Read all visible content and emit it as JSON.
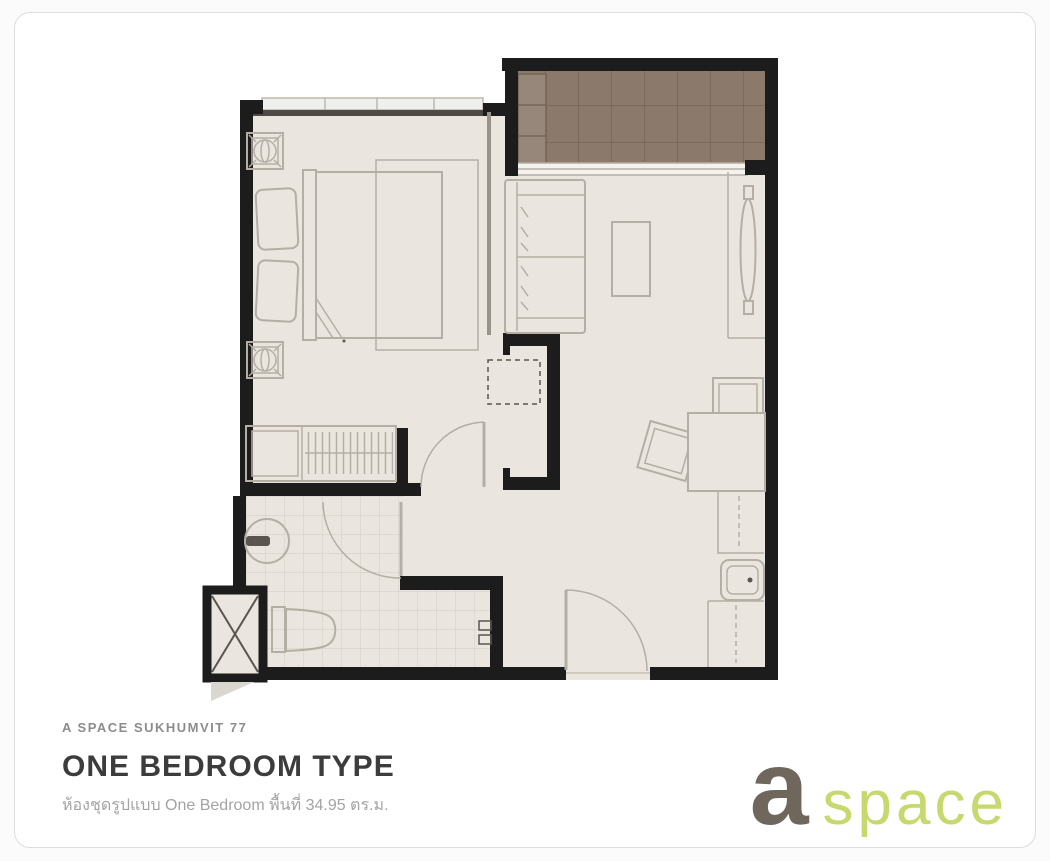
{
  "plan": {
    "kind": "condominium unit floor plan",
    "unit_type": "One Bedroom",
    "area_sqm": "34.95",
    "features": [
      "balcony",
      "bedroom",
      "living-area",
      "bathroom",
      "closet",
      "kitchen-counter",
      "entrance-door",
      "service-shaft"
    ]
  },
  "footer": {
    "project": "A SPACE SUKHUMVIT 77",
    "title": "ONE BEDROOM TYPE",
    "caption": "ห้องชุดรูปแบบ One Bedroom พื้นที่ 34.95 ตร.ม."
  },
  "logo": {
    "mark": "a",
    "word": "space"
  },
  "colors": {
    "page_bg": "#fbfbfb",
    "card_bg": "#ffffff",
    "card_border": "#dddddd",
    "wall": "#1c1c1c",
    "wall_soft": "#4f4b44",
    "wall_thin": "#9a9488",
    "floor": "#eae6df",
    "tile_line": "#d6d1c7",
    "balcony": "#8b7a6b",
    "balcony_line": "#6f6150",
    "balcony_unit": "#96877a",
    "window": "#eff0ee",
    "furniture": "#b4aea4",
    "furniture_dark": "#5a564f",
    "threshold": "#cfcabf",
    "shaft_flap": "#dad7d1",
    "project_text": "#8c8c8c",
    "title_text": "#3c3c3c",
    "caption_text": "#a3a3a3",
    "logo_a": "#6f665c",
    "logo_space": "#c5d96e"
  }
}
